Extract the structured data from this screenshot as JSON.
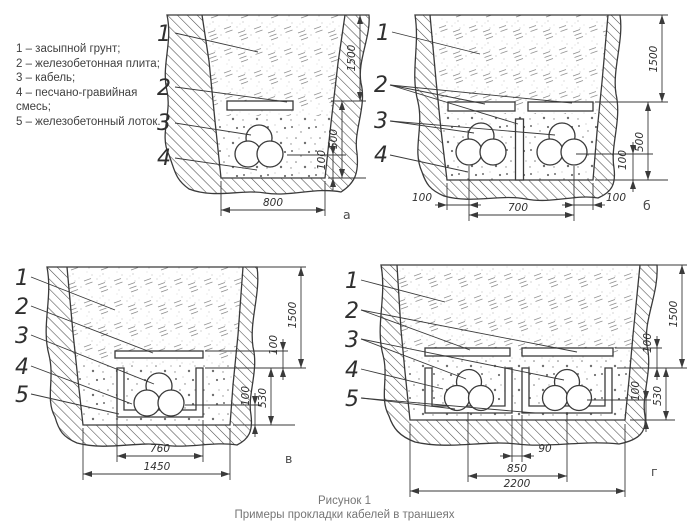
{
  "legend": {
    "items": [
      "1 – засыпной грунт;",
      "2 – железобетонная плита;",
      "3 – кабель;",
      "4 – песчано-гравийная смесь;",
      "5 – железобетонный лоток."
    ]
  },
  "caption": {
    "line1": "Рисунок 1",
    "line2": "Примеры прокладки кабелей в траншеях"
  },
  "figures": {
    "a": {
      "label": "а",
      "leaders": [
        "1",
        "2",
        "3",
        "4"
      ],
      "dims": {
        "depth": "1500",
        "below_slab": "500",
        "bedding": "100",
        "bottom_width": "800"
      }
    },
    "b": {
      "label": "б",
      "leaders": [
        "1",
        "2",
        "3",
        "4"
      ],
      "dims": {
        "depth": "1500",
        "below_slab": "500",
        "bedding": "100",
        "edge_left": "100",
        "between_cables": "700",
        "edge_right": "100"
      }
    },
    "v": {
      "label": "в",
      "leaders": [
        "1",
        "2",
        "3",
        "4",
        "5"
      ],
      "dims": {
        "depth": "1500",
        "above_tray": "100",
        "bedding": "100",
        "tray_zone": "530",
        "tray_width": "760",
        "bottom_width": "1450"
      }
    },
    "g": {
      "label": "г",
      "leaders": [
        "1",
        "2",
        "3",
        "4",
        "5"
      ],
      "dims": {
        "depth": "1500",
        "above_tray": "100",
        "bedding": "100",
        "tray_zone": "530",
        "tray_gap": "90",
        "tray_spacing": "850",
        "bottom_width": "2200"
      }
    }
  }
}
